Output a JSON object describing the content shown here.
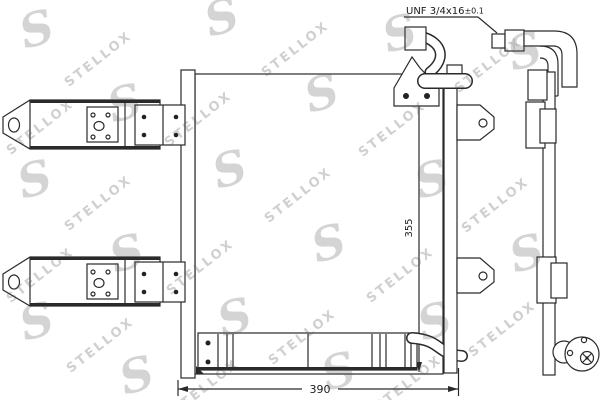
{
  "canvas": {
    "background": "#ffffff",
    "line_color": "#2a2a2a"
  },
  "callout": {
    "thread": "UNF 3/4x16",
    "tolerance": "±0.1"
  },
  "dimensions": {
    "width_mm": "390",
    "height_mm": "355"
  },
  "watermark": {
    "text": "STELLOX",
    "letter": "S"
  }
}
